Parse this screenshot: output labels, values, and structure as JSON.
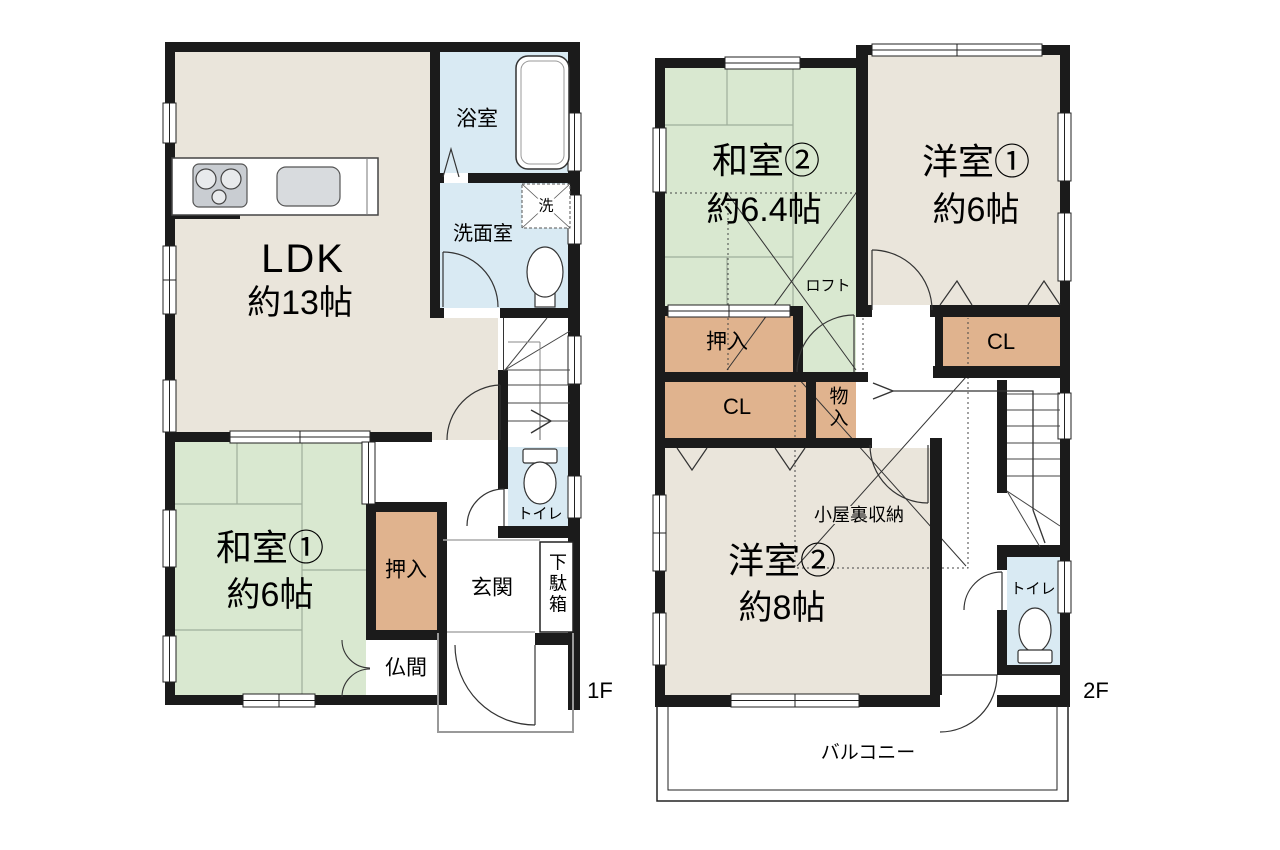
{
  "floors": {
    "f1": {
      "floor_label": "1F",
      "ldk": {
        "name": "LDK",
        "size": "約13帖"
      },
      "washitsu1": {
        "name": "和室①",
        "size": "約6帖"
      },
      "bathroom": "浴室",
      "washroom": "洗面室",
      "laundry": "洗",
      "toilet": "トイレ",
      "oshiire": "押入",
      "butsuma": "仏間",
      "genkan": "玄関",
      "getabako": "下駄箱"
    },
    "f2": {
      "floor_label": "2F",
      "washitsu2": {
        "name": "和室②",
        "size": "約6.4帖"
      },
      "youshitsu1": {
        "name": "洋室①",
        "size": "約6帖"
      },
      "youshitsu2": {
        "name": "洋室②",
        "size": "約8帖"
      },
      "loft": "ロフト",
      "oshiire": "押入",
      "closet_left": "CL",
      "closet_right": "CL",
      "monoire": "物入",
      "attic": "小屋裏収納",
      "toilet": "トイレ",
      "balcony": "バルコニー"
    }
  },
  "colors": {
    "wall": "#1b1b1b",
    "floor_beige": "#eae5db",
    "tatami_green": "#d9e8d0",
    "closet_tan": "#e0b38e",
    "water_blue": "#d9eaf3",
    "line": "#333333",
    "porch": "#999999"
  }
}
